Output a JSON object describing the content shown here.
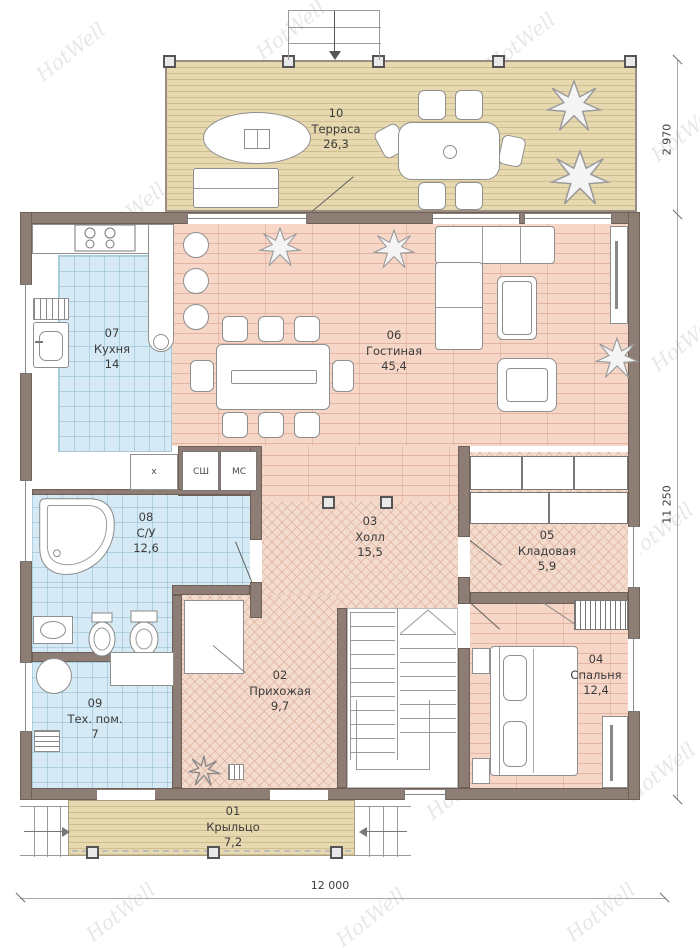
{
  "watermark": {
    "text": "HotWell"
  },
  "rooms": [
    {
      "number": "01",
      "name": "Крыльцо",
      "area": "7,2"
    },
    {
      "number": "02",
      "name": "Прихожая",
      "area": "9,7"
    },
    {
      "number": "03",
      "name": "Холл",
      "area": "15,5"
    },
    {
      "number": "04",
      "name": "Спальня",
      "area": "12,4"
    },
    {
      "number": "05",
      "name": "Кладовая",
      "area": "5,9"
    },
    {
      "number": "06",
      "name": "Гостиная",
      "area": "45,4"
    },
    {
      "number": "07",
      "name": "Кухня",
      "area": "14"
    },
    {
      "number": "08",
      "name": "С/У",
      "area": "12,6"
    },
    {
      "number": "09",
      "name": "Тех. пом.",
      "area": "7"
    },
    {
      "number": "10",
      "name": "Терраса",
      "area": "26,3"
    }
  ],
  "closet_labels": [
    "х",
    "СШ",
    "МС"
  ],
  "dimensions": {
    "terrace_depth": "2 970",
    "house_depth": "11 250",
    "house_width": "12 000"
  },
  "colors": {
    "wall": "#8e7d74",
    "tile_floor": "#d6eaf5",
    "plank_floor": "#f6d6c6",
    "herringbone_floor": "#f3dbcd",
    "terrace_floor": "#e7d9af",
    "watermark": "#d4d4d4"
  }
}
